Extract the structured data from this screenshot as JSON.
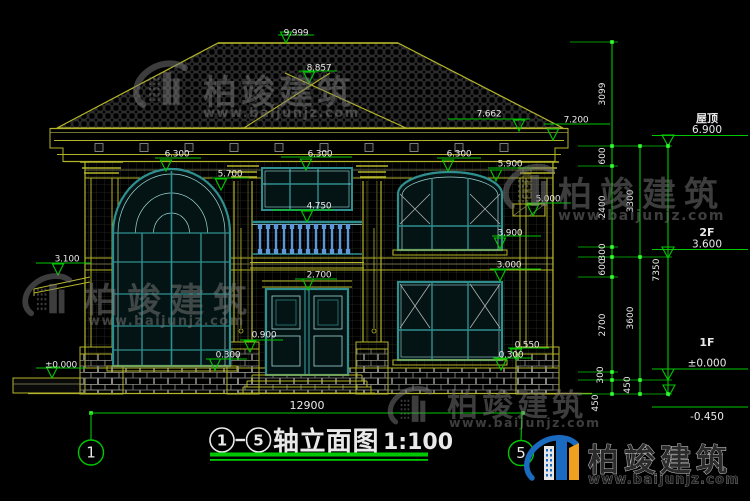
{
  "colors": {
    "green": "#00c800",
    "node_green": "#33ff33",
    "dim_text": "#e9e9e9",
    "yellow": "#b5b52a",
    "yellow_dim": "#8f8f2a",
    "teal": "#2f8f8f",
    "teal_light": "#9fd6d6",
    "glass": "#041414",
    "baluster_blue": "#5e97dd",
    "watermark_gray": "#7a7a7a",
    "brand_blue": "#1a6abf",
    "brand_orange": "#efa01f"
  },
  "watermark": {
    "brand": "柏竣建筑",
    "url": "www.baijunjz.com"
  },
  "watermark_instances": [
    {
      "x": 168,
      "y": 90,
      "s": 1.05,
      "ts": 34,
      "ls": 4,
      "tx": 203,
      "ty": 104,
      "us": 13,
      "ux": 203,
      "uy": 117
    },
    {
      "x": 536,
      "y": 192,
      "s": 1.0,
      "ts": 34,
      "ls": 8,
      "tx": 558,
      "ty": 206,
      "us": 14,
      "ux": 558,
      "uy": 220
    },
    {
      "x": 54,
      "y": 300,
      "s": 0.95,
      "ts": 34,
      "ls": 9,
      "tx": 84,
      "ty": 312,
      "us": 13,
      "ux": 88,
      "uy": 325
    },
    {
      "x": 416,
      "y": 410,
      "s": 0.85,
      "ts": 31,
      "ls": 4,
      "tx": 447,
      "ty": 416,
      "us": 12.5,
      "ux": 449,
      "uy": 427
    }
  ],
  "brand_logo": {
    "x": 558,
    "y": 464,
    "text_x": 588,
    "text_y": 471,
    "url_y": 483.5
  },
  "drawing": {
    "title": {
      "axis_start": "1",
      "axis_end": "5",
      "title_text": "轴立面图",
      "scale_text": "1:100"
    },
    "overall_width_dim": {
      "value": "12900",
      "x1": 91,
      "x2": 523,
      "y": 413,
      "text_x": 307,
      "text_y": 409
    },
    "axis_bubbles": [
      {
        "label": "1",
        "cx": 91,
        "cy": 452.5,
        "leader": [
          91,
          413,
          91,
          440
        ]
      },
      {
        "label": "5",
        "cx": 521,
        "cy": 453,
        "leader": [
          522,
          412,
          521,
          440.5
        ]
      }
    ],
    "spot_elevations": [
      {
        "v": "9.999",
        "t": [
          296,
          32
        ],
        "l": [
          278,
          314,
          35
        ],
        "p": [
          286,
          43
        ]
      },
      {
        "v": "8.857",
        "t": [
          319,
          67
        ],
        "l": [
          299,
          337,
          71
        ],
        "p": [
          309,
          83
        ]
      },
      {
        "v": "7.662",
        "t": [
          489,
          113
        ],
        "l": [
          448,
          530,
          119
        ],
        "p": [
          519,
          131
        ]
      },
      {
        "v": "7.200",
        "t": [
          576,
          119
        ],
        "l": [
          544,
          610,
          124
        ],
        "p": [
          553,
          140
        ]
      },
      {
        "v": "6.300",
        "t": [
          177,
          153
        ],
        "l": [
          155,
          201,
          158
        ],
        "p": [
          166,
          171
        ]
      },
      {
        "v": "6.300",
        "t": [
          320,
          153
        ],
        "l": [
          281,
          352,
          157
        ],
        "p": [
          306,
          170
        ]
      },
      {
        "v": "6.300",
        "t": [
          459,
          153
        ],
        "l": [
          437,
          481,
          158
        ],
        "p": [
          448,
          171
        ]
      },
      {
        "v": "5.900",
        "t": [
          510,
          163
        ],
        "l": [
          488,
          532,
          168
        ],
        "p": [
          496,
          181
        ]
      },
      {
        "v": "5.700",
        "t": [
          230,
          173
        ],
        "l": [
          212,
          249,
          178
        ],
        "p": [
          221,
          190
        ]
      },
      {
        "v": "5.000",
        "t": [
          548,
          198
        ],
        "l": [
          527,
          571,
          203
        ],
        "p": [
          533,
          216
        ]
      },
      {
        "v": "4.750",
        "t": [
          319,
          205
        ],
        "l": [
          272,
          334,
          210
        ],
        "p": [
          307,
          222
        ]
      },
      {
        "v": "3.900",
        "t": [
          510,
          232
        ],
        "l": [
          492,
          541,
          236
        ],
        "p": [
          500,
          249
        ]
      },
      {
        "v": "3.100",
        "t": [
          67,
          258
        ],
        "l": [
          36,
          91,
          263
        ],
        "p": [
          58,
          275
        ]
      },
      {
        "v": "3.000",
        "t": [
          509,
          264
        ],
        "l": [
          490,
          541,
          269
        ],
        "p": [
          500,
          281
        ]
      },
      {
        "v": "2.700",
        "t": [
          319,
          274
        ],
        "l": [
          295,
          337,
          279
        ],
        "p": [
          308,
          290
        ]
      },
      {
        "v": "0.900",
        "t": [
          264,
          334
        ],
        "l": [
          240,
          283,
          340
        ],
        "p": [
          250,
          352
        ]
      },
      {
        "v": "0.550",
        "t": [
          527,
          344
        ],
        "l": [
          508,
          549,
          348
        ],
        "p": [
          516,
          360
        ]
      },
      {
        "v": "0.300",
        "t": [
          228,
          354
        ],
        "l": [
          206,
          247,
          359
        ],
        "p": [
          215,
          370
        ]
      },
      {
        "v": "0.300",
        "t": [
          511,
          354
        ],
        "l": [
          493,
          532,
          358
        ],
        "p": [
          501,
          370
        ]
      },
      {
        "v": "±0.000",
        "t": [
          61,
          364
        ],
        "l": [
          36,
          85,
          368
        ],
        "p": [
          52,
          378
        ]
      }
    ],
    "level_markers": [
      {
        "floor": "屋顶",
        "elev": "6.900",
        "fy": 122,
        "vy": 133,
        "ly": 135.5,
        "p": [
          668,
          146
        ]
      },
      {
        "floor": "2F",
        "elev": "3.600",
        "fy": 236,
        "vy": 247.5,
        "ly": 249.5,
        "p": [
          668,
          258
        ]
      },
      {
        "floor": "1F",
        "elev": "±0.000",
        "fy": 346,
        "vy": 366.5,
        "ly": 369,
        "p": [
          668,
          380
        ]
      },
      {
        "floor": "",
        "elev": "-0.450",
        "fy": 0,
        "vy": 420,
        "ly": 407,
        "p": [
          669,
          396
        ]
      }
    ],
    "level_marker_line": [
      652,
      748
    ],
    "dimension_chains": [
      {
        "x": 612,
        "nodes": [
          42,
          146,
          166,
          247,
          257,
          277,
          372,
          380,
          394
        ],
        "labels": [
          [
            "3099",
            94,
            -7
          ],
          [
            "600",
            156,
            -7
          ],
          [
            "2400",
            207,
            -7
          ],
          [
            "300",
            252,
            -7
          ],
          [
            "600",
            267,
            -7
          ],
          [
            "2700",
            325,
            -7
          ],
          [
            "300",
            375,
            -9
          ],
          [
            "450",
            403,
            -14
          ]
        ]
      },
      {
        "x": 640,
        "nodes": [
          146,
          257,
          380,
          394
        ],
        "labels": [
          [
            "3300",
            201,
            -7
          ],
          [
            "3600",
            318,
            -7
          ],
          [
            "450",
            385,
            -10
          ]
        ]
      },
      {
        "x": 668,
        "nodes": [
          146,
          394
        ],
        "labels": [
          [
            "7350",
            270,
            -9
          ]
        ]
      }
    ],
    "extension_lines": [
      [
        570,
        618,
        42
      ],
      [
        578,
        672,
        146
      ],
      [
        578,
        618,
        166
      ],
      [
        578,
        618,
        247
      ],
      [
        578,
        672,
        257
      ],
      [
        578,
        618,
        277
      ],
      [
        578,
        618,
        372
      ],
      [
        578,
        672,
        380
      ],
      [
        578,
        672,
        394
      ]
    ]
  }
}
